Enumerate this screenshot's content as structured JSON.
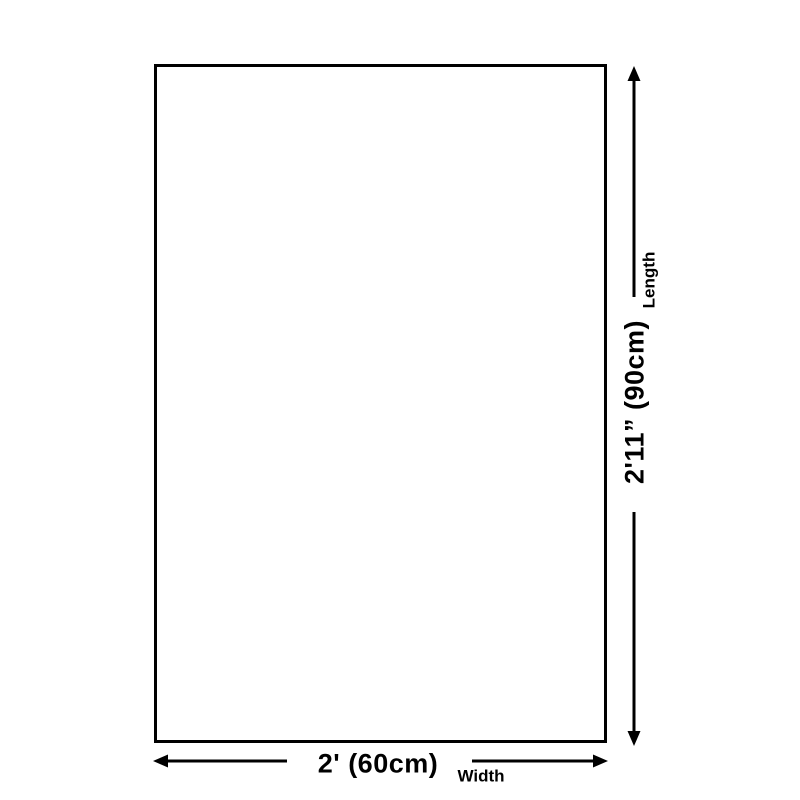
{
  "diagram": {
    "type": "product-dimension-diagram",
    "background_color": "#ffffff",
    "line_color": "#000000",
    "rectangle": {
      "description": "blank rectangular outline representing the product"
    },
    "width_dimension": {
      "value_label": "2' (60cm)",
      "axis_label": "Width",
      "orientation": "horizontal",
      "position": "bottom"
    },
    "length_dimension": {
      "value_label": "2'11” (90cm)",
      "axis_label": "Length",
      "orientation": "vertical",
      "position": "right"
    }
  }
}
